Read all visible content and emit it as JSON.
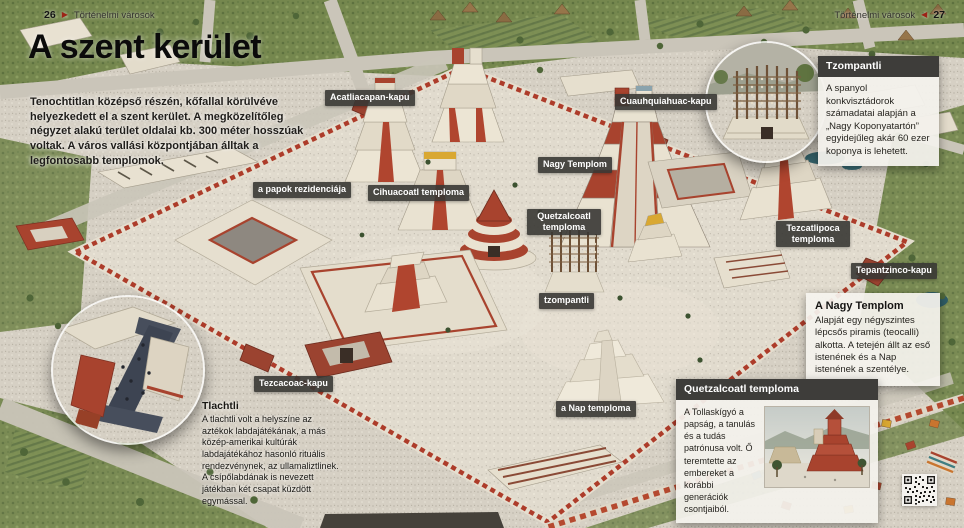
{
  "page": {
    "left_header": {
      "page_number": "26",
      "section": "Történelmi városok"
    },
    "right_header": {
      "page_number": "27",
      "section": "Történelmi városok"
    }
  },
  "icons": {
    "page_arrow_right": "▶",
    "page_arrow_left": "◀"
  },
  "title": "A szent kerület",
  "intro": "Tenochtitlan középső részén, kőfallal körülvéve helyezkedett el a szent kerület. A megközelítőleg négyzet alakú terület oldalai kb. 300 méter hosszúak voltak. A város vallási központjában álltak a legfontosabb templomok.",
  "map_labels": [
    {
      "id": "acatliacapan-kapu",
      "text": "Acatliacapan-kapu"
    },
    {
      "id": "cuauhquiahuac-kapu",
      "text": "Cuauhquiahuac-kapu"
    },
    {
      "id": "nagy-templom",
      "text": "Nagy Templom"
    },
    {
      "id": "papok-rezidenciaja",
      "text": "a papok rezidenciája"
    },
    {
      "id": "cihuacoatl-temploma",
      "text": "Cihuacoatl temploma"
    },
    {
      "id": "quetzalcoatl-temploma",
      "text": "Quetzalcoatl temploma"
    },
    {
      "id": "tezcatlipoca-temploma",
      "text": "Tezcatlipoca temploma"
    },
    {
      "id": "tepantzinco-kapu",
      "text": "Tepantzinco-kapu"
    },
    {
      "id": "tzompantli",
      "text": "tzompantli"
    },
    {
      "id": "tezcacoac-kapu",
      "text": "Tezcacoac-kapu"
    },
    {
      "id": "nap-temploma",
      "text": "a Nap temploma"
    }
  ],
  "callouts": {
    "tzompantli": {
      "title": "Tzompantli",
      "body": "A spanyol konkvisztádorok számadatai alapján a „Nagy Koponyatartón” egyidejűleg akár 60 ezer koponya is lehetett."
    },
    "nagy_templom": {
      "title": "A Nagy Templom",
      "body": "Alapját egy négyszintes lépcsős piramis (teocalli) alkotta. A tetején állt az eső istenének és a Nap istenének a szentélye."
    },
    "quetzalcoatl": {
      "title": "Quetzalcoatl temploma",
      "body": "A Tollaskígyó a papság, a tanulás és a tudás patrónusa volt. Ő teremtette az embereket a korábbi generációk csontjaiból."
    },
    "tlachtli": {
      "title": "Tlachtli",
      "body": "A tlachtli volt a helyszíne az aztékok labdajátékának, a más közép-amerikai kultúrák labdajátékához hasonló rituális rendezvénynek, az ullamaliztlinek. A csípőlabdának is nevezett játékban két csapat küzdött egymással."
    }
  },
  "colors": {
    "label_bg": "#383734",
    "callout_header_bg": "#3e3d3a",
    "callout_body_bg": "#f3f1ec",
    "wall_red": "#a8432e",
    "accent_yellow": "#d9a832",
    "plaza": "#d6d0c4",
    "vegetation": "#6d8049",
    "header_arrow_red": "#9c2417"
  }
}
